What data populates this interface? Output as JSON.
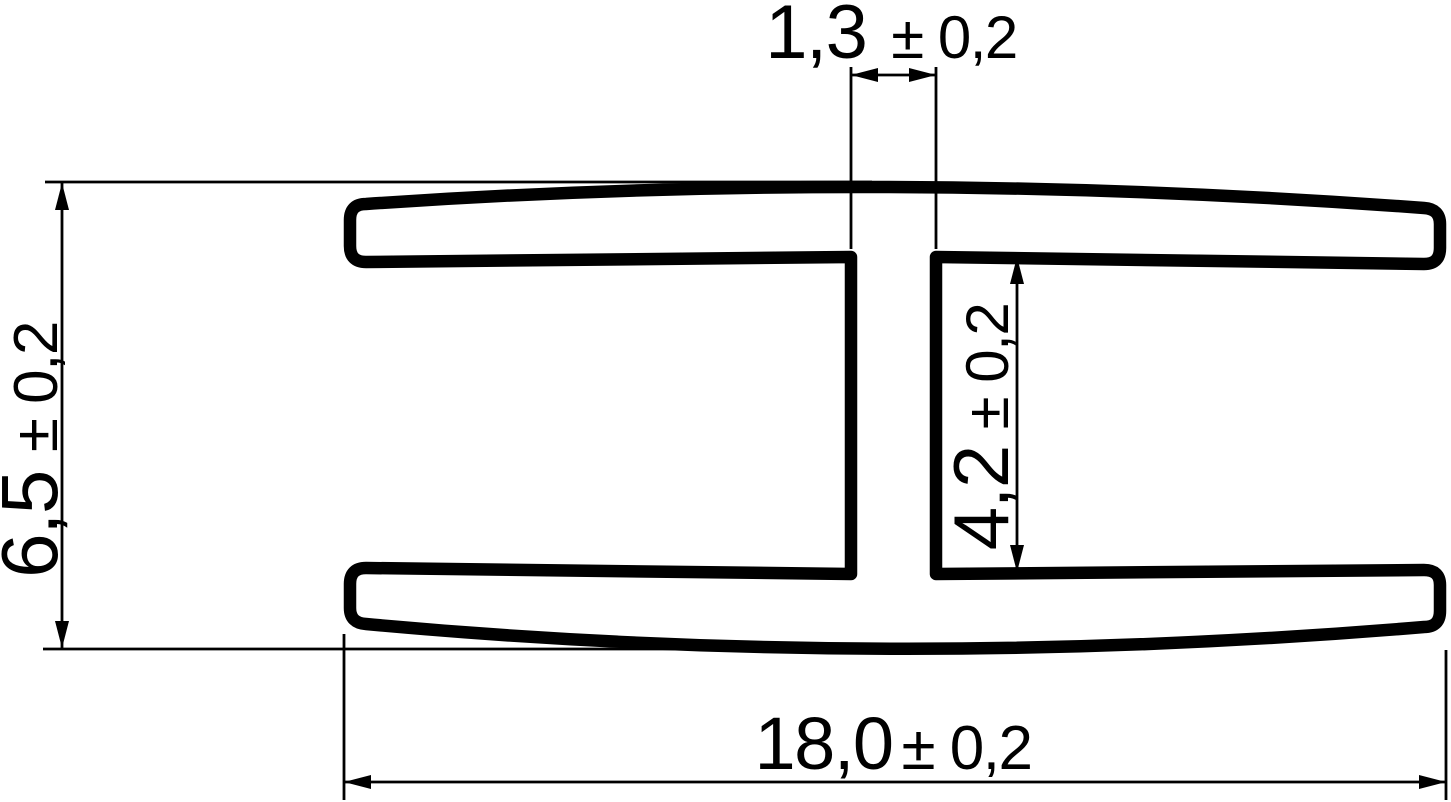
{
  "colors": {
    "line": "#000000",
    "background": "#ffffff"
  },
  "dimensions": {
    "web_width": {
      "value": "1,3",
      "tolerance": "± 0,2"
    },
    "overall_height": {
      "value": "6,5",
      "tolerance": "± 0,2"
    },
    "inner_height": {
      "value": "4,2",
      "tolerance": "± 0,2"
    },
    "overall_width": {
      "value": "18,0",
      "tolerance": "± 0,2"
    }
  }
}
